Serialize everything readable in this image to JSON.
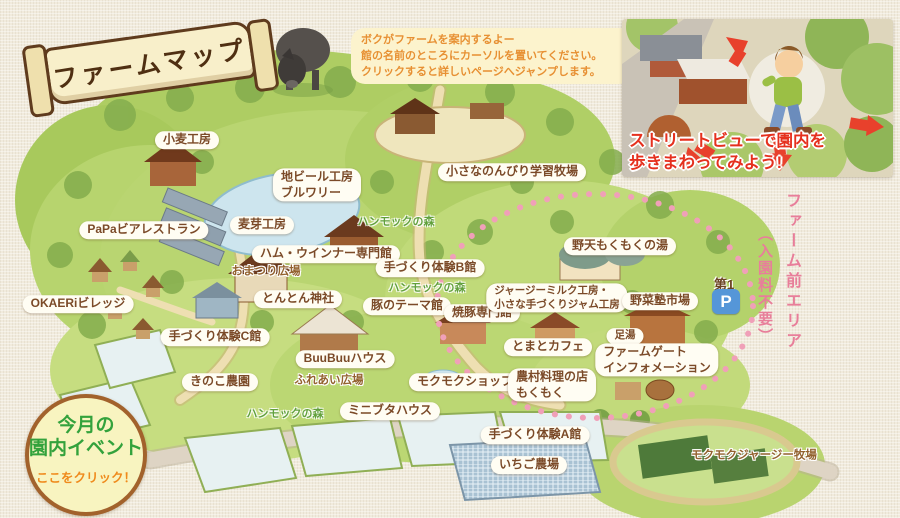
{
  "banner": {
    "text": "ファームマップ"
  },
  "guide_bubble": {
    "lines": [
      "ボクがファームを案内するよー",
      "館の名前のところにカーソルを置いてください。",
      "クリックすると詳しいページへジャンプします。"
    ]
  },
  "streetview_promo": {
    "lines": [
      "ストリートビューで園内を",
      "歩きまわってみよう!"
    ]
  },
  "event_badge": {
    "title_line1": "今月の",
    "title_line2": "園内イベント",
    "cta": "ここをクリック！"
  },
  "farm_front_area": {
    "name": "ファーム前エリア",
    "note": "（入園料不要）"
  },
  "parking": {
    "area_label": "第1",
    "symbol": "P"
  },
  "colors": {
    "label_text_brown": "#7b4a28",
    "forest_label_green": "#61a03b",
    "area_note_pink": "#e87e9a",
    "guide_text_orange": "#e79033",
    "event_title_green": "#33a23c",
    "event_cta_orange": "#ef8a1c",
    "streetview_text_red": "#e5301e",
    "parking_blue": "#5596d8",
    "map_green": "#b7d36e",
    "dotted_circle_pink": "#f0a0b8"
  },
  "map": {
    "labels": [
      {
        "id": "label-komugi-kobo",
        "x": 187,
        "y": 140,
        "style": "bubble",
        "link": true,
        "lines": [
          "小麦工房"
        ]
      },
      {
        "id": "label-jibeer-brewery",
        "x": 317,
        "y": 185,
        "style": "bubble align-left",
        "link": true,
        "lines": [
          "地ビール工房",
          "ブルワリー"
        ]
      },
      {
        "id": "label-nonbiri-gakushu-bokujo",
        "x": 512,
        "y": 172,
        "style": "bubble",
        "link": true,
        "lines": [
          "小さなのんびり学習牧場"
        ]
      },
      {
        "id": "label-papa-beer-restaurant",
        "x": 144,
        "y": 230,
        "style": "bubble",
        "link": true,
        "lines": [
          "PaPaビアレストラン"
        ]
      },
      {
        "id": "label-bakuga-kobo",
        "x": 262,
        "y": 225,
        "style": "bubble",
        "link": true,
        "lines": [
          "麦芽工房"
        ]
      },
      {
        "id": "label-ham-wiener-senmonkan",
        "x": 326,
        "y": 254,
        "style": "bubble",
        "link": true,
        "lines": [
          "ハム・ウインナー専門館"
        ]
      },
      {
        "id": "label-tezukuri-taiken-b",
        "x": 430,
        "y": 268,
        "style": "bubble",
        "link": true,
        "lines": [
          "手づくり体験B館"
        ]
      },
      {
        "id": "label-tonton-jinja",
        "x": 298,
        "y": 299,
        "style": "bubble",
        "link": true,
        "lines": [
          "とんとん神社"
        ]
      },
      {
        "id": "label-buta-theme-kan",
        "x": 407,
        "y": 306,
        "style": "bubble",
        "link": true,
        "lines": [
          "豚のテーマ館"
        ]
      },
      {
        "id": "label-okaeri-village",
        "x": 78,
        "y": 304,
        "style": "bubble",
        "link": true,
        "lines": [
          "OKAERiビレッジ"
        ]
      },
      {
        "id": "label-tezukuri-taiken-c",
        "x": 215,
        "y": 337,
        "style": "bubble",
        "link": true,
        "lines": [
          "手づくり体験C館"
        ]
      },
      {
        "id": "label-buubuu-house",
        "x": 345,
        "y": 359,
        "style": "bubble",
        "link": true,
        "lines": [
          "BuuBuuハウス"
        ]
      },
      {
        "id": "label-kinoko-nouen",
        "x": 220,
        "y": 382,
        "style": "bubble",
        "link": true,
        "lines": [
          "きのこ農園"
        ]
      },
      {
        "id": "label-minibuta-house",
        "x": 390,
        "y": 411,
        "style": "bubble",
        "link": true,
        "lines": [
          "ミニブタハウス"
        ]
      },
      {
        "id": "label-mokumoku-shop",
        "x": 465,
        "y": 382,
        "style": "bubble",
        "link": true,
        "lines": [
          "モクモクショップ"
        ]
      },
      {
        "id": "label-yakibuta-senmonkan",
        "x": 482,
        "y": 313,
        "style": "bubble",
        "link": true,
        "lines": [
          "焼豚専門館"
        ]
      },
      {
        "id": "label-jersey-milk-kobo",
        "x": 557,
        "y": 298,
        "style": "bubble small align-left",
        "link": true,
        "lines": [
          "ジャージーミルク工房・",
          "小さな手づくりジャム工房"
        ]
      },
      {
        "id": "label-noten-mokumoku-no-yu",
        "x": 620,
        "y": 246,
        "style": "bubble",
        "link": true,
        "lines": [
          "野天もくもくの湯"
        ]
      },
      {
        "id": "label-yasai-juku-ichiba",
        "x": 660,
        "y": 301,
        "style": "bubble",
        "link": true,
        "lines": [
          "野菜塾市場"
        ]
      },
      {
        "id": "label-ashiyu",
        "x": 625,
        "y": 336,
        "style": "bubble small",
        "link": true,
        "lines": [
          "足湯"
        ]
      },
      {
        "id": "label-tomato-cafe",
        "x": 548,
        "y": 347,
        "style": "bubble",
        "link": true,
        "lines": [
          "とまとカフェ"
        ]
      },
      {
        "id": "label-farm-gate-information",
        "x": 657,
        "y": 360,
        "style": "bubble align-left",
        "link": true,
        "lines": [
          "ファームゲート",
          "インフォメーション"
        ]
      },
      {
        "id": "label-nouson-ryori-mokumoku",
        "x": 552,
        "y": 385,
        "style": "bubble align-left",
        "link": true,
        "lines": [
          "農村料理の店",
          "もくもく"
        ]
      },
      {
        "id": "label-tezukuri-taiken-a",
        "x": 535,
        "y": 435,
        "style": "bubble",
        "link": true,
        "lines": [
          "手づくり体験A館"
        ]
      },
      {
        "id": "label-ichigo-nojo",
        "x": 529,
        "y": 465,
        "style": "bubble",
        "link": true,
        "lines": [
          "いちご農場"
        ]
      },
      {
        "id": "label-omatsuri-hiroba",
        "x": 266,
        "y": 272,
        "style": "plain small",
        "link": false,
        "lines": [
          "おまつり広場"
        ]
      },
      {
        "id": "label-fureai-hiroba",
        "x": 329,
        "y": 381,
        "style": "plain",
        "link": false,
        "lines": [
          "ふれあい広場"
        ]
      },
      {
        "id": "label-mokumoku-jersey-bokujo",
        "x": 754,
        "y": 456,
        "style": "plain",
        "link": true,
        "lines": [
          "モクモクジャージー牧場"
        ]
      },
      {
        "id": "label-hammock-forest-1",
        "x": 396,
        "y": 222,
        "style": "forest",
        "link": false,
        "lines": [
          "ハンモックの森"
        ]
      },
      {
        "id": "label-hammock-forest-2",
        "x": 427,
        "y": 288,
        "style": "forest",
        "link": false,
        "lines": [
          "ハンモックの森"
        ]
      },
      {
        "id": "label-hammock-forest-3",
        "x": 285,
        "y": 414,
        "style": "forest",
        "link": false,
        "lines": [
          "ハンモックの森"
        ]
      }
    ]
  }
}
